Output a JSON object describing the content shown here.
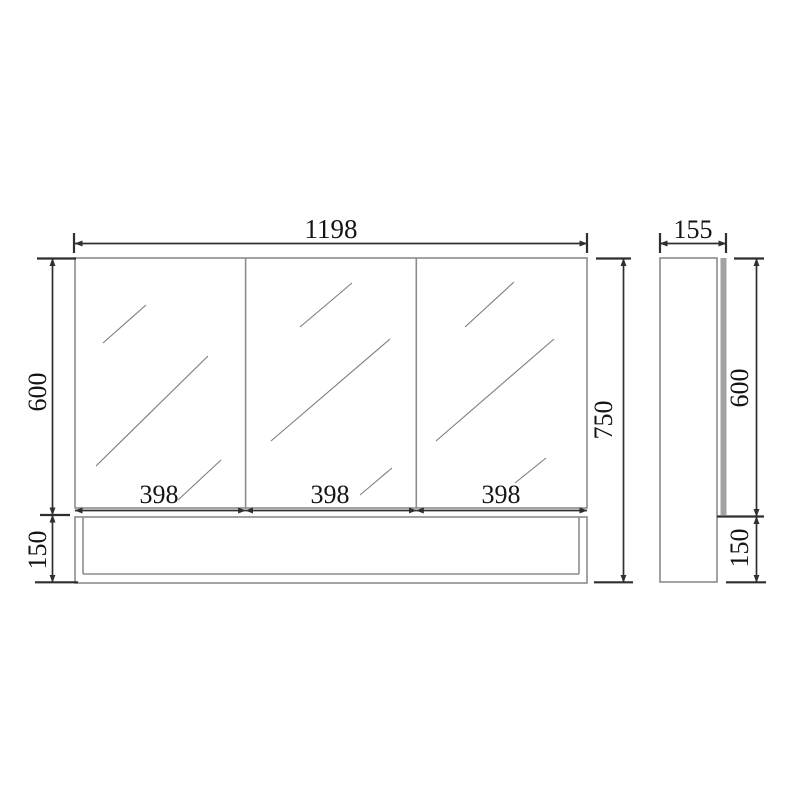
{
  "drawing": {
    "front_view": {
      "overall_width": "1198",
      "overall_height": "750",
      "mirror_section_height": "600",
      "shelf_height": "150",
      "door_widths": [
        "398",
        "398",
        "398"
      ]
    },
    "side_view": {
      "depth": "155",
      "mirror_section_height": "600",
      "shelf_height": "150"
    },
    "colors": {
      "outline": "#8c8c8c",
      "dimension_line": "#2f2f2f",
      "text": "#141414",
      "mirror_panel_fill": "#a2a2a2",
      "background": "#ffffff"
    }
  }
}
